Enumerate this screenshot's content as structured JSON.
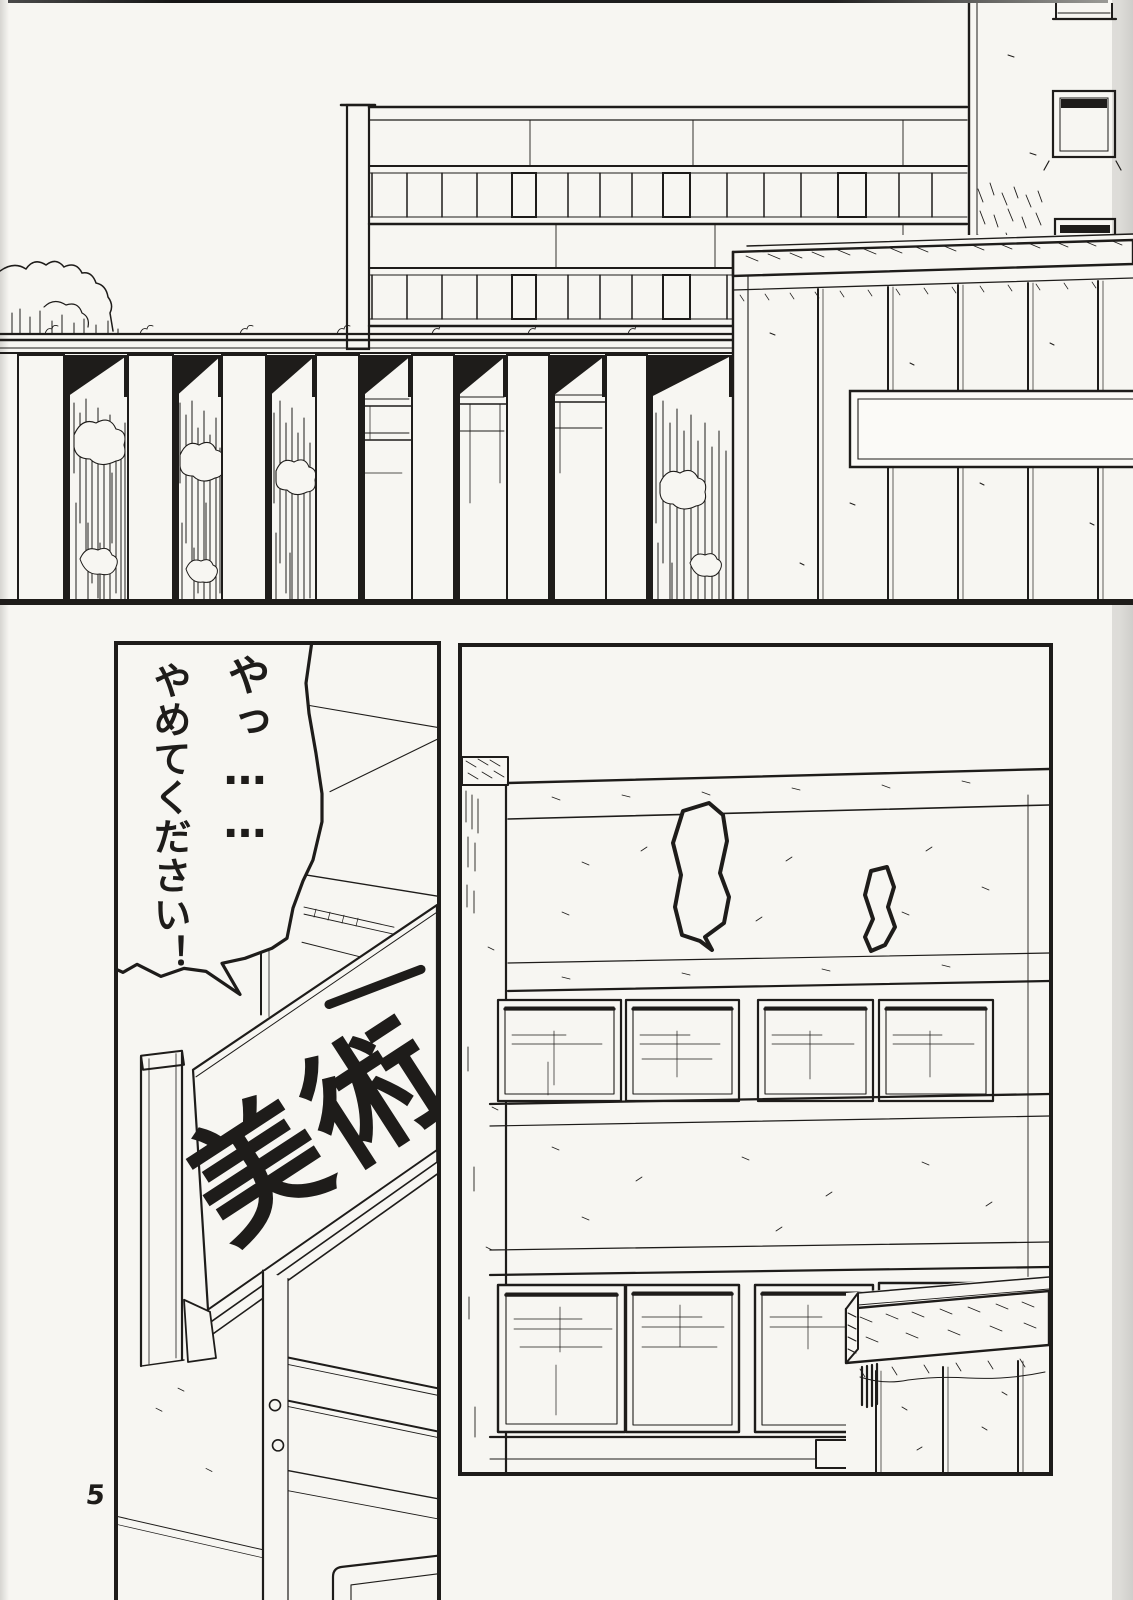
{
  "page_number": "5",
  "speech_bubble": {
    "line_1": "やっ……",
    "line_2": "やめてください！"
  },
  "sign": {
    "text": "美術",
    "partial_character": "一"
  },
  "colors": {
    "ink": "#1e1c1a",
    "paper": "#f7f6f2",
    "scan_edge": "#d6d5d1"
  }
}
